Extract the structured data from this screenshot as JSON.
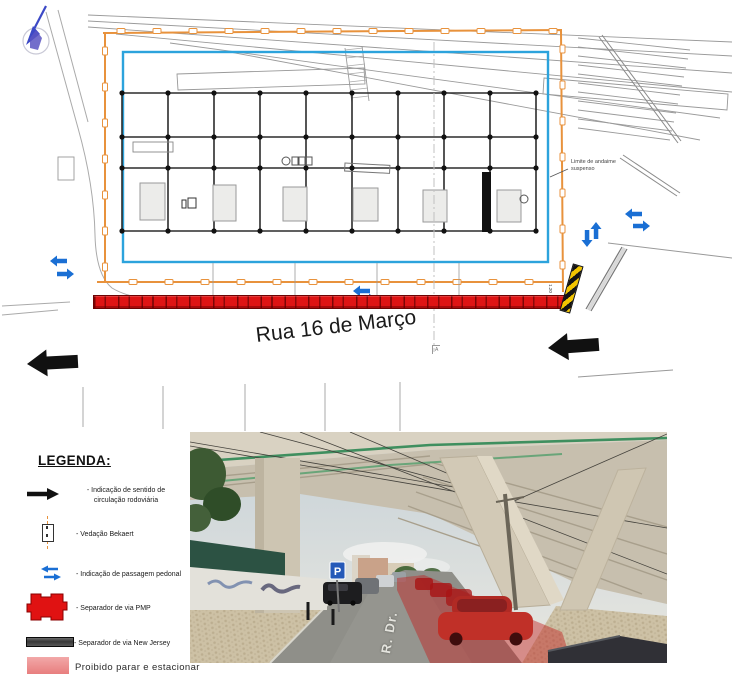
{
  "plan": {
    "street_name": "Rua 16 de Março",
    "scaffold_limit_note": "Limite de andaime suspenso",
    "section_marker": "A",
    "dimension_label": "1.20"
  },
  "legend": {
    "title": "LEGENDA:",
    "items": [
      {
        "icon": "direction-arrow-icon",
        "label": "- Indicação de sentido de circulação rodoviária"
      },
      {
        "icon": "bekaert-fence-icon",
        "label": "- Vedação Bekaert"
      },
      {
        "icon": "pedestrian-crossing-icon",
        "label": "- Indicação de passagem pedonal"
      },
      {
        "icon": "pmp-separator-icon",
        "label": "- Separador de via PMP"
      },
      {
        "icon": "new-jersey-separator-icon",
        "label": "- Separador de via New Jersey"
      },
      {
        "icon": "no-stopping-zone-icon",
        "label": "Proibido parar e estacionar"
      }
    ]
  },
  "photo": {
    "parking_sign": "P",
    "road_label": "R. Dr."
  },
  "colors": {
    "fence_orange": "#E8923C",
    "work_area_blue": "#2CA3DC",
    "separator_red": "#DE1414",
    "pedestrian_arrow_blue": "#1A6FD4",
    "traffic_arrow_black": "#111111",
    "new_jersey_gray": "#4A4A4A",
    "no_stopping_pink": "#EC9090"
  }
}
